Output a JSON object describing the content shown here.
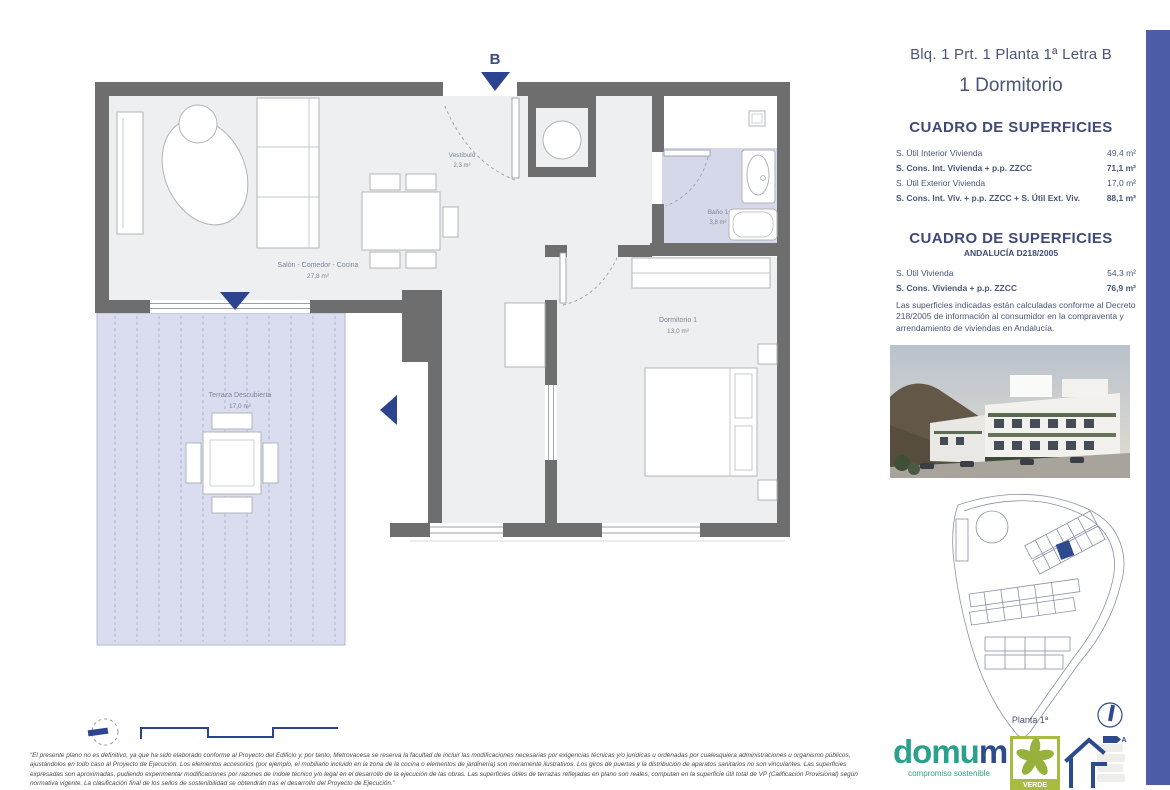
{
  "plan": {
    "entrance_label": "B",
    "rooms": [
      {
        "name": "Vestíbulo",
        "area": "2,3 m²"
      },
      {
        "name": "Salón - Comedor - Cocina",
        "area": "27,8 m²"
      },
      {
        "name": "Baño 1",
        "area": "3,8 m²"
      },
      {
        "name": "Dormitorio 1",
        "area": "13,0 m²"
      },
      {
        "name": "Terraza Descubierta",
        "area": "17,0 m²"
      }
    ]
  },
  "sidebar": {
    "title": "Blq. 1 Prt. 1 Planta 1ª Letra B",
    "subtitle": "1 Dormitorio",
    "table1": {
      "heading": "CUADRO DE SUPERFICIES",
      "rows": [
        {
          "label": "S. Útil Interior Vivienda",
          "value": "49,4 m²"
        },
        {
          "label": "S. Cons. Int. Vivienda + p.p. ZZCC",
          "value": "71,1 m²"
        },
        {
          "label": "S. Útil Exterior Vivienda",
          "value": "17,0 m²"
        },
        {
          "label": "S. Cons. Int. Viv. + p.p. ZZCC + S. Útil Ext. Viv.",
          "value": "88,1 m²"
        }
      ]
    },
    "table2": {
      "heading": "CUADRO DE SUPERFICIES",
      "subheading": "ANDALUCÍA D218/2005",
      "rows": [
        {
          "label": "S. Útil Vivienda",
          "value": "54,3 m²"
        },
        {
          "label": "S. Cons. Vivienda + p.p. ZZCC",
          "value": "76,9 m²"
        }
      ],
      "note": "Las superficies indicadas están calculadas conforme al Decreto 218/2005 de información al consumidor en la compraventa y arrendamiento de viviendas en Andalucía."
    },
    "siteplan_label": "Planta 1ª"
  },
  "footer": {
    "disclaimer": "“El presente plano no es definitivo, ya que ha sido elaborado conforme al Proyecto del Edificio y, por tanto, Metrovacesa se reserva la facultad de incluir las modificaciones necesarias por exigencias técnicas y/o jurídicas u ordenadas por cualesquiera administraciones u organismo públicos, ajustándolos en todo caso al Proyecto de Ejecución. Los elementos accesorios (por ejemplo, el mobiliario incluido en la zona de la cocina o elementos de jardinería) son meramente ilustrativos. Los giros de puertas y la distribución de aparatos sanitarios no son vinculantes. Las superficies expresadas son aproximadas, pudiendo experimentar modificaciones por razones de índole técnico y/o legal en el desarrollo de la ejecución de las obras. Las superficies útiles de terrazas reflejadas en plano son reales, computan en la superficie útil total de VP (Calificación Provisional) según normativa vigente. La clasificación final de los sellos de sostenibilidad se obtendrán tras el desarrollo del Proyecto de Ejecución.”"
  },
  "logos": {
    "domum_part1": "domu",
    "domum_part2": "m",
    "domum_tagline": "compromiso sostenible",
    "verde_label": "VERDE",
    "energy_letter": "A"
  },
  "colors": {
    "accent_navy": "#2c4390",
    "wall_gray": "#6e6e6e",
    "floor_gray": "#edeff0",
    "lavender": "#d6d9e9",
    "side_bar_blue": "#4d5da7",
    "domum_teal": "#2aa18c",
    "verde_green": "#9cb53c"
  }
}
